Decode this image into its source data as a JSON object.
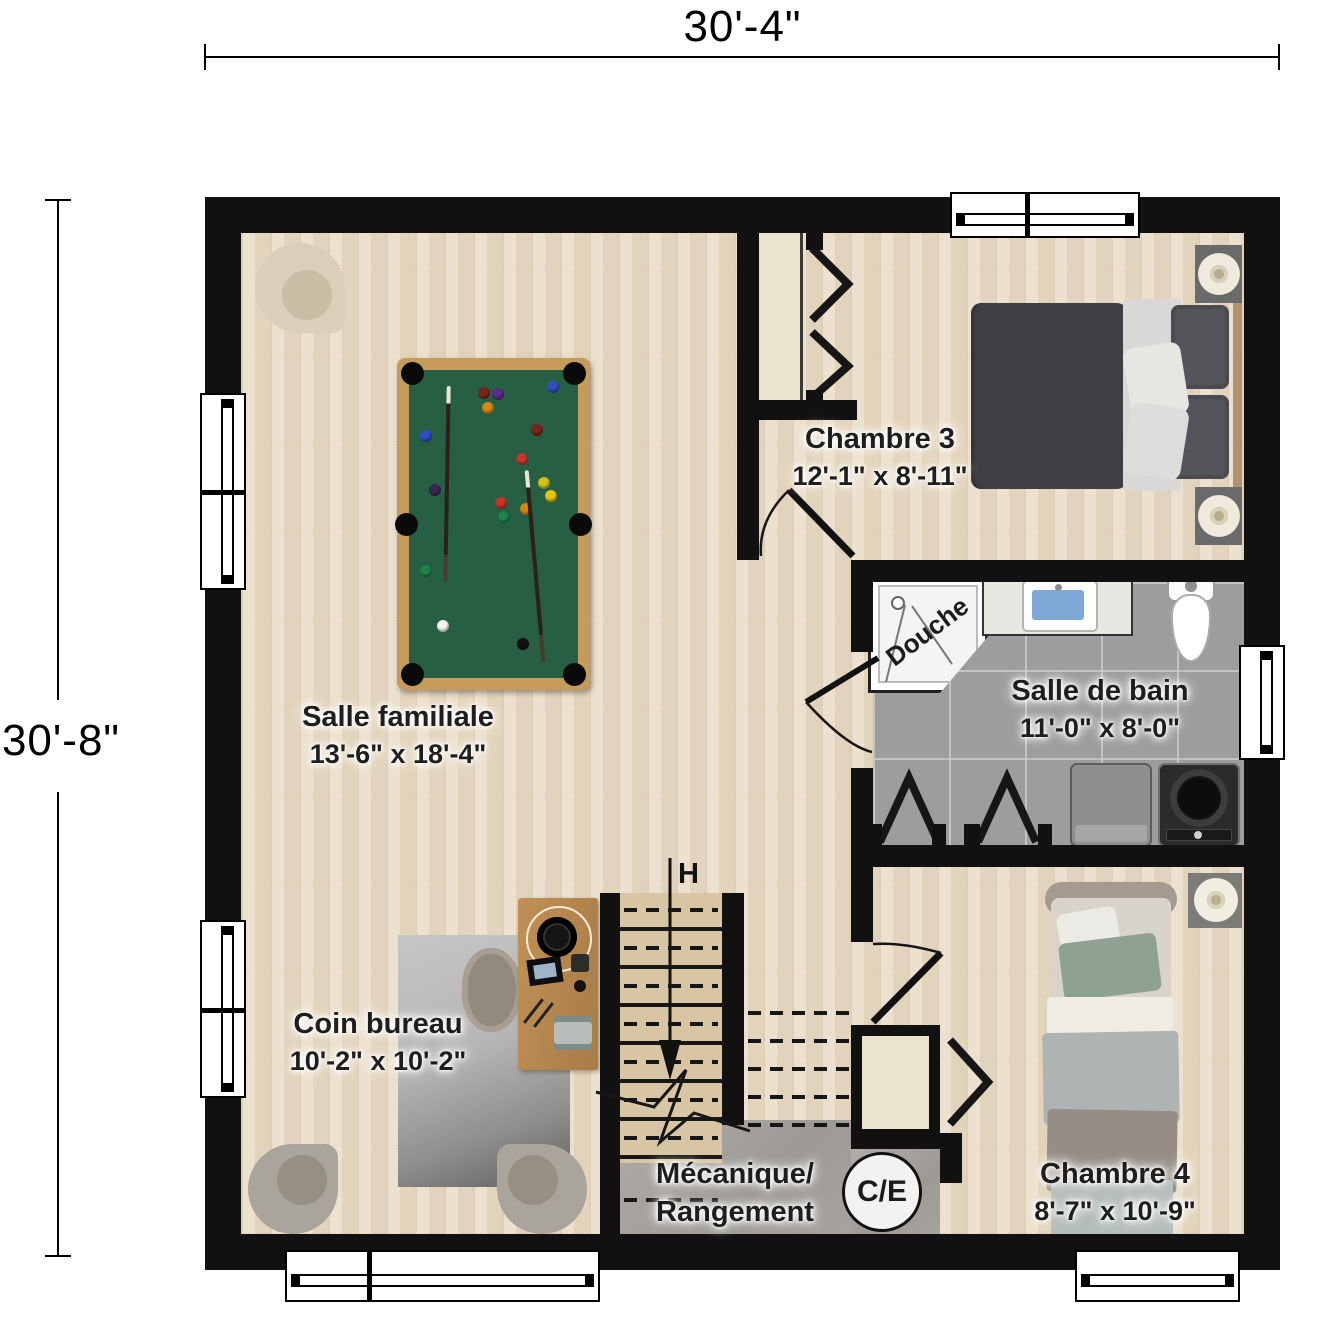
{
  "dimensions": {
    "width": "30'-4\"",
    "height": "30'-8\""
  },
  "rooms": {
    "chambre3": {
      "name": "Chambre 3",
      "size": "12'-1\" x 8'-11\""
    },
    "salle_familiale": {
      "name": "Salle familiale",
      "size": "13'-6\" x 18'-4\""
    },
    "salle_de_bain": {
      "name": "Salle de bain",
      "size": "11'-0\" x 8'-0\""
    },
    "coin_bureau": {
      "name": "Coin bureau",
      "size": "10'-2\" x 10'-2\""
    },
    "mecanique": {
      "line1": "Mécanique/",
      "line2": "Rangement"
    },
    "chambre4": {
      "name": "Chambre 4",
      "size": "8'-7\" x 10'-9\""
    }
  },
  "labels": {
    "shower": "Douche",
    "stairs": "H",
    "panel": "C/E"
  },
  "colors": {
    "wall": "#111111",
    "wood_floor": "#e8dcc6",
    "bath_tile": "#9d9d9d",
    "concrete": "#a6a39e",
    "pool_felt": "#265f44",
    "pool_wood": "#c69a5a",
    "closet_fill": "#eae4cf",
    "sink_water": "#7fa8d9"
  }
}
